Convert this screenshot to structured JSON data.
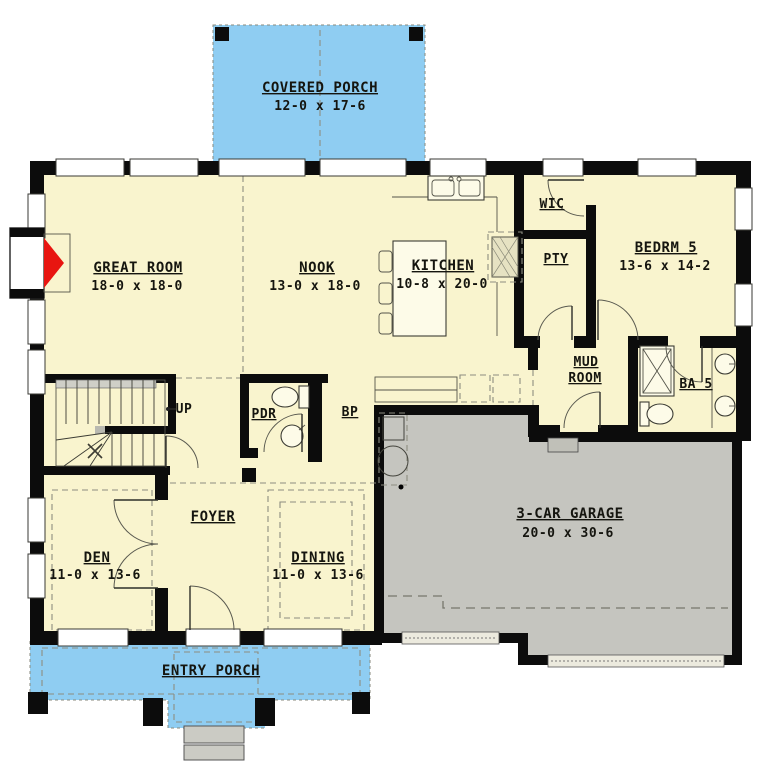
{
  "plan_title": "first-floor-plan",
  "rooms": {
    "covered_porch": {
      "name": "COVERED PORCH",
      "dims": "12-0 x 17-6"
    },
    "great_room": {
      "name": "GREAT ROOM",
      "dims": "18-0 x 18-0"
    },
    "nook": {
      "name": "NOOK",
      "dims": "13-0 x 18-0"
    },
    "kitchen": {
      "name": "KITCHEN",
      "dims": "10-8 x 20-0"
    },
    "wic": {
      "name": "WIC"
    },
    "pantry": {
      "name": "PTY"
    },
    "bedroom5": {
      "name": "BEDRM 5",
      "dims": "13-6 x 14-2"
    },
    "mud_room": {
      "line1": "MUD",
      "line2": "ROOM"
    },
    "bath5": {
      "name": "BA 5"
    },
    "powder": {
      "name": "PDR"
    },
    "butlers_pantry": {
      "name": "BP"
    },
    "foyer": {
      "name": "FOYER"
    },
    "den": {
      "name": "DEN",
      "dims": "11-0 x 13-6"
    },
    "dining": {
      "name": "DINING",
      "dims": "11-0 x 13-6"
    },
    "garage": {
      "name": "3-CAR GARAGE",
      "dims": "20-0 x 30-6"
    },
    "entry_porch": {
      "name": "ENTRY PORCH"
    },
    "stairs": {
      "label": "UP"
    }
  },
  "colors": {
    "floor": "#f9f4ce",
    "porch": "#8fcdf2",
    "garage": "#c5c5bf",
    "steps": "#cbcbc4",
    "fireplace": "#e81510",
    "wall": "#0c0c0c"
  }
}
